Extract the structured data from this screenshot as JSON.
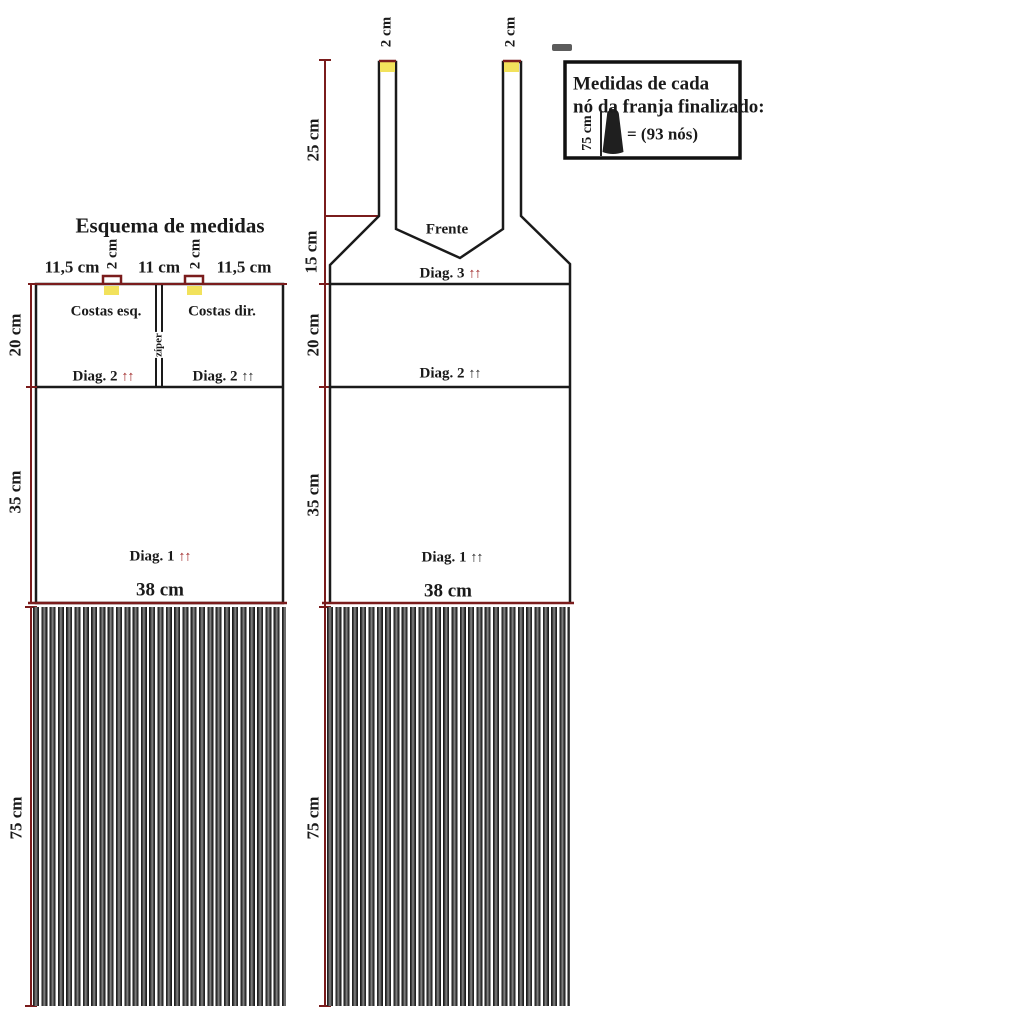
{
  "title": "Esquema de medidas",
  "back_piece": {
    "top_measurements": {
      "left": "11,5 cm",
      "tab_left": "2 cm",
      "center": "11 cm",
      "tab_right": "2 cm",
      "right": "11,5 cm"
    },
    "panel_left_label": "Costas esq.",
    "panel_right_label": "Costas dir.",
    "zipper_label": "zíper",
    "diag2_left": "Diag. 2",
    "diag2_right": "Diag. 2",
    "diag1": "Diag. 1",
    "arrows": "↑↑",
    "height_top": "20 cm",
    "height_middle": "35 cm",
    "fringe_height": "75 cm",
    "bottom_width": "38 cm"
  },
  "front_piece": {
    "label": "Frente",
    "strap_left_width": "2 cm",
    "strap_right_width": "2 cm",
    "height_strap": "25 cm",
    "height_neck": "15 cm",
    "height_top": "20 cm",
    "height_middle": "35 cm",
    "fringe_height": "75 cm",
    "diag3": "Diag. 3",
    "diag2": "Diag. 2",
    "diag1": "Diag. 1",
    "arrows": "↑↑",
    "bottom_width": "38 cm"
  },
  "legend": {
    "line1": "Medidas de cada",
    "line2": "nó da franja finalizado:",
    "knot_height": "75 cm",
    "knot_count": "= (93 nós)"
  },
  "colors": {
    "dimension_line": "#7a1c1c",
    "accent_red": "#9b1c1c",
    "tab_yellow": "#f2e25c",
    "ink": "#1a1a1a"
  }
}
